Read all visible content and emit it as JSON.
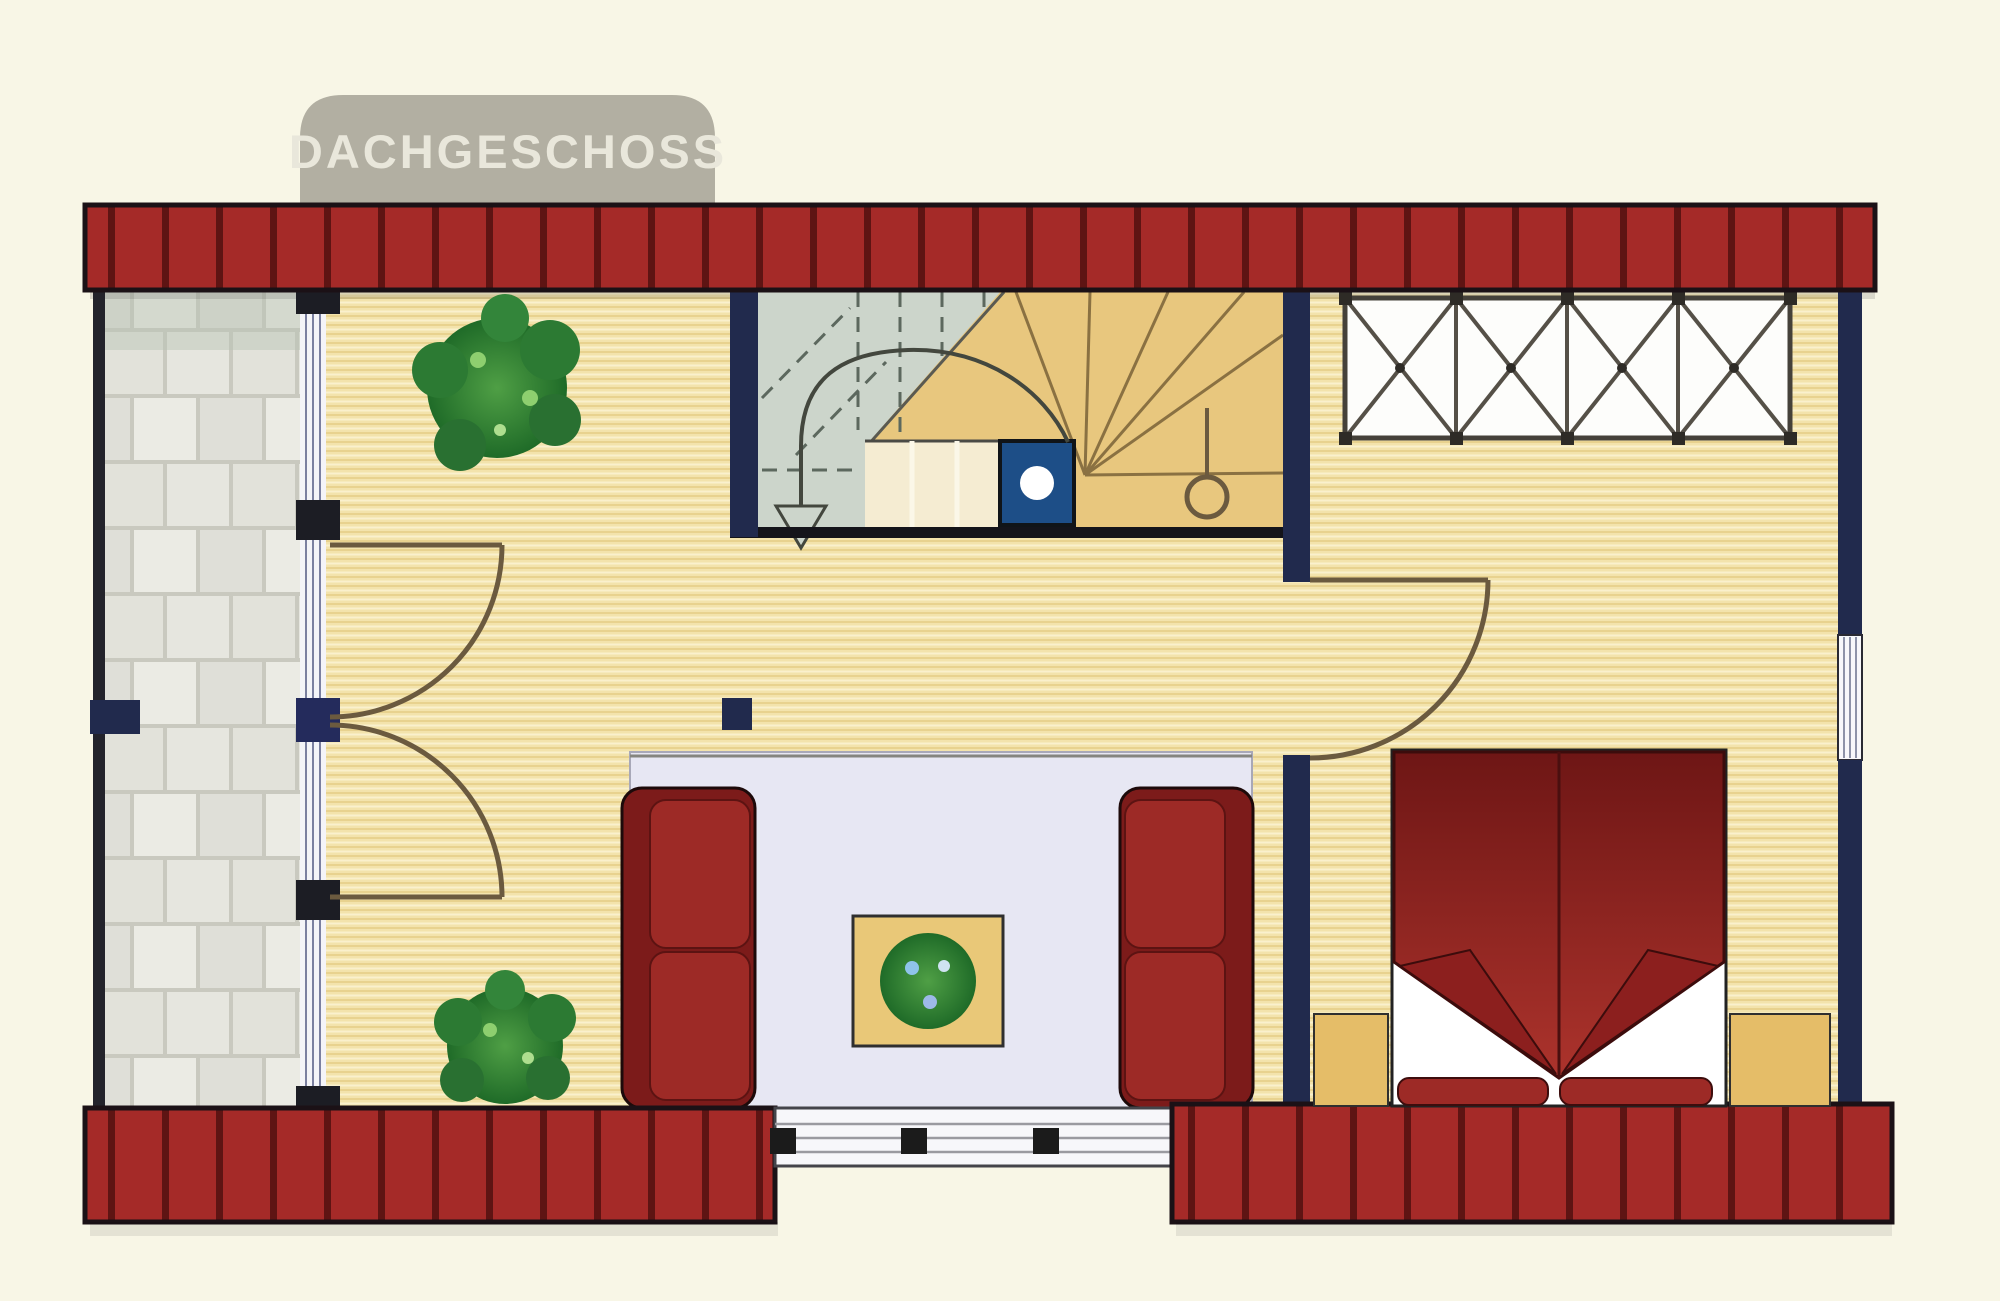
{
  "floor_plan": {
    "badge_label": "DACHGESCHOSS"
  },
  "colors": {
    "background": "#f8f6e6",
    "badge_bg": "#b2afa2",
    "badge_text": "#e9e7db",
    "brick_red": "#a52a28",
    "brick_line": "#5e1413",
    "wall_navy": "#212a4d",
    "wood_floor": "#f3e3ac",
    "stair_gray": "#ccd5cb",
    "stair_gold": "#e8c77e",
    "chimney_blue": "#1d4e87",
    "sofa_red": "#9d2a26",
    "sofa_dark_red": "#7c1b1a",
    "bed_red_dark": "#6e1615",
    "bed_red": "#ac332c",
    "rug": "#e7e7f3",
    "table_gold": "#e9c878",
    "plant_green": "#2f7d35",
    "door_arc": "#6b5a3f",
    "window_white": "#f7f7fa"
  }
}
